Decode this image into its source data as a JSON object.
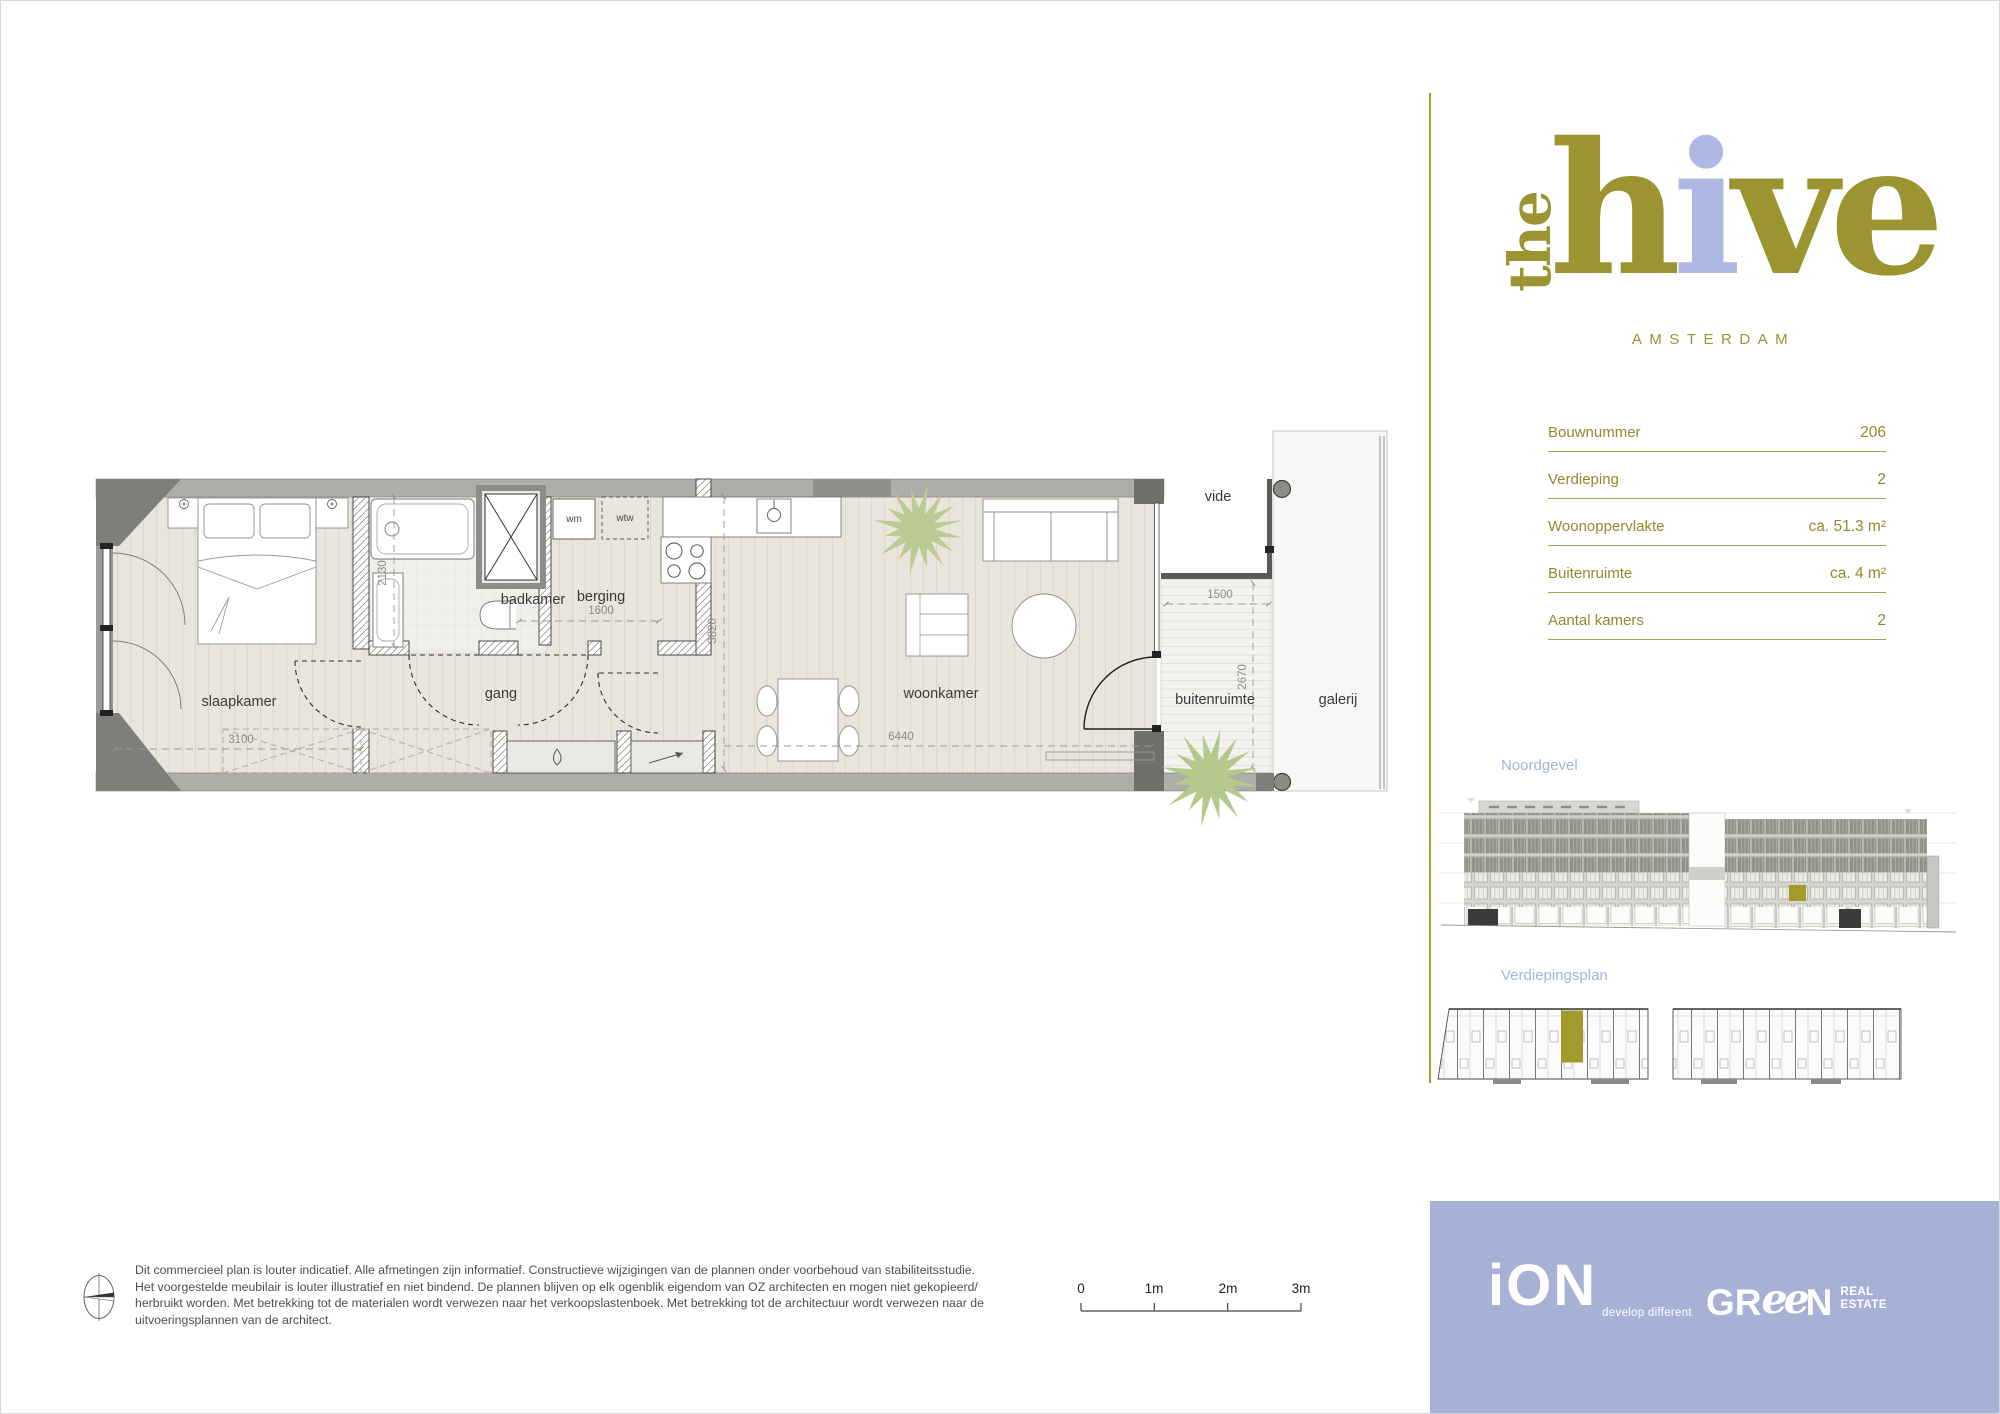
{
  "brand": {
    "logo_the": "the",
    "logo_h": "h",
    "logo_i": "i",
    "logo_ve": "ve",
    "city": "AMSTERDAM",
    "olive": "#9c9331",
    "periwinkle": "#aeb9e3"
  },
  "unit_info": {
    "rows": [
      {
        "label": "Bouwnummer",
        "value": "206"
      },
      {
        "label": "Verdieping",
        "value": "2"
      },
      {
        "label": "Woonoppervlakte",
        "value": "ca. 51.3 m²"
      },
      {
        "label": "Buitenruimte",
        "value": "ca. 4 m²"
      },
      {
        "label": "Aantal kamers",
        "value": "2"
      }
    ]
  },
  "sections": {
    "north_facade": "Noordgevel",
    "floor_overview": "Verdiepingsplan"
  },
  "floorplan": {
    "room_labels": [
      {
        "text": "slaapkamer",
        "x": 238,
        "y": 705
      },
      {
        "text": "badkamer",
        "x": 532,
        "y": 603
      },
      {
        "text": "berging",
        "x": 600,
        "y": 600
      },
      {
        "text": "gang",
        "x": 500,
        "y": 697
      },
      {
        "text": "woonkamer",
        "x": 940,
        "y": 697
      },
      {
        "text": "buitenruimte",
        "x": 1214,
        "y": 703
      },
      {
        "text": "galerij",
        "x": 1337,
        "y": 703
      },
      {
        "text": "vide",
        "x": 1217,
        "y": 500
      }
    ],
    "equipment_labels": [
      {
        "text": "wm",
        "x": 573,
        "y": 521
      },
      {
        "text": "wtw",
        "x": 624,
        "y": 520
      }
    ],
    "dimensions": [
      {
        "text": "3100",
        "x": 240,
        "y": 742,
        "rot": 0
      },
      {
        "text": "2130",
        "x": 385,
        "y": 572,
        "rot": -90
      },
      {
        "text": "1600",
        "x": 600,
        "y": 613,
        "rot": 0
      },
      {
        "text": "3820",
        "x": 715,
        "y": 630,
        "rot": -90
      },
      {
        "text": "6440",
        "x": 900,
        "y": 739,
        "rot": 0
      },
      {
        "text": "1500",
        "x": 1219,
        "y": 597,
        "rot": 0
      },
      {
        "text": "2670",
        "x": 1245,
        "y": 676,
        "rot": -90
      }
    ]
  },
  "scalebar": {
    "labels": [
      "0",
      "1m",
      "2m",
      "3m"
    ]
  },
  "disclaimer": {
    "lines": [
      "Dit commercieel plan is louter indicatief. Alle afmetingen zijn informatief. Constructieve wijzigingen van de plannen onder voorbehoud van stabiliteitsstudie.",
      "Het voorgestelde meubilair is louter illustratief en niet bindend. De plannen blijven op elk ogenblik eigendom van OZ architecten en mogen niet gekopieerd/",
      "herbruikt worden. Met betrekking tot de materialen wordt verwezen naar het verkoopslastenboek. Met betrekking tot de architectuur wordt verwezen naar de",
      "uitvoeringsplannen van de architect."
    ]
  },
  "footer": {
    "ion_name": "iON",
    "ion_tagline": "develop different",
    "green_gr": "GR",
    "green_ee": "ee",
    "green_n": "N",
    "green_real": "REAL",
    "green_estate": "ESTATE"
  }
}
